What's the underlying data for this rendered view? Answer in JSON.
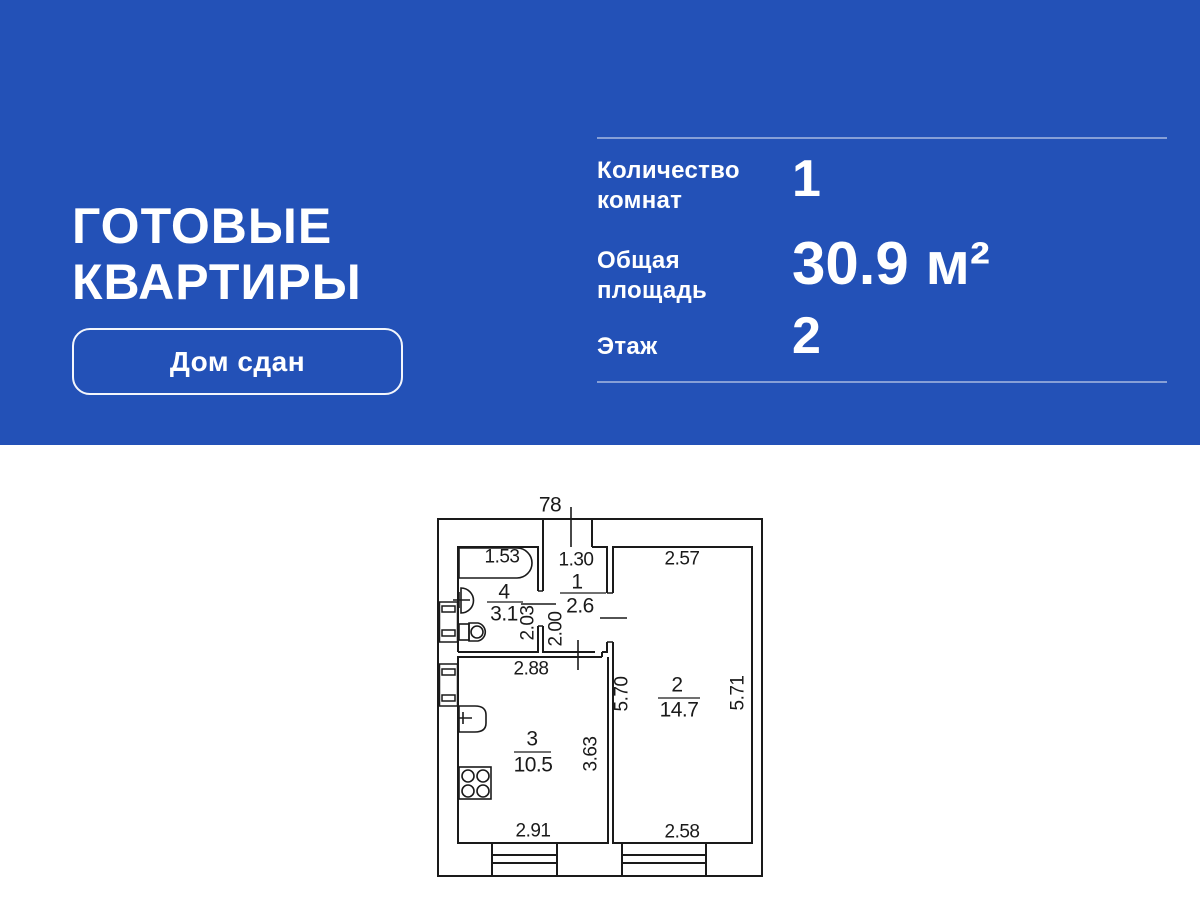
{
  "banner": {
    "title_line1": "ГОТОВЫЕ",
    "title_line2": "КВАРТИРЫ",
    "badge_label": "Дом сдан",
    "stats": [
      {
        "label": "Количество комнат",
        "value": "1"
      },
      {
        "label": "Общая площадь",
        "value": "30.9 м²"
      },
      {
        "label": "Этаж",
        "value": "2"
      }
    ]
  },
  "floor_plan": {
    "entry_door_width": "78",
    "rooms": [
      {
        "number": "1",
        "area": "2.6"
      },
      {
        "number": "2",
        "area": "14.7"
      },
      {
        "number": "3",
        "area": "10.5"
      },
      {
        "number": "4",
        "area": "3.1"
      }
    ],
    "dimensions": {
      "bathroom_width": "1.53",
      "hall_width": "1.30",
      "living_room_top": "2.57",
      "bathroom_depth": "2.03",
      "hall_depth": "2.00",
      "kitchen_width_top": "2.88",
      "living_room_left": "5.70",
      "living_room_right": "5.71",
      "kitchen_depth": "3.63",
      "kitchen_width_bottom": "2.91",
      "living_room_bottom": "2.58"
    }
  },
  "colors": {
    "banner_background": "#2351b7",
    "banner_text": "#ffffff",
    "divider": "rgba(255,255,255,0.45)",
    "plan_line": "#1a1a1a"
  }
}
